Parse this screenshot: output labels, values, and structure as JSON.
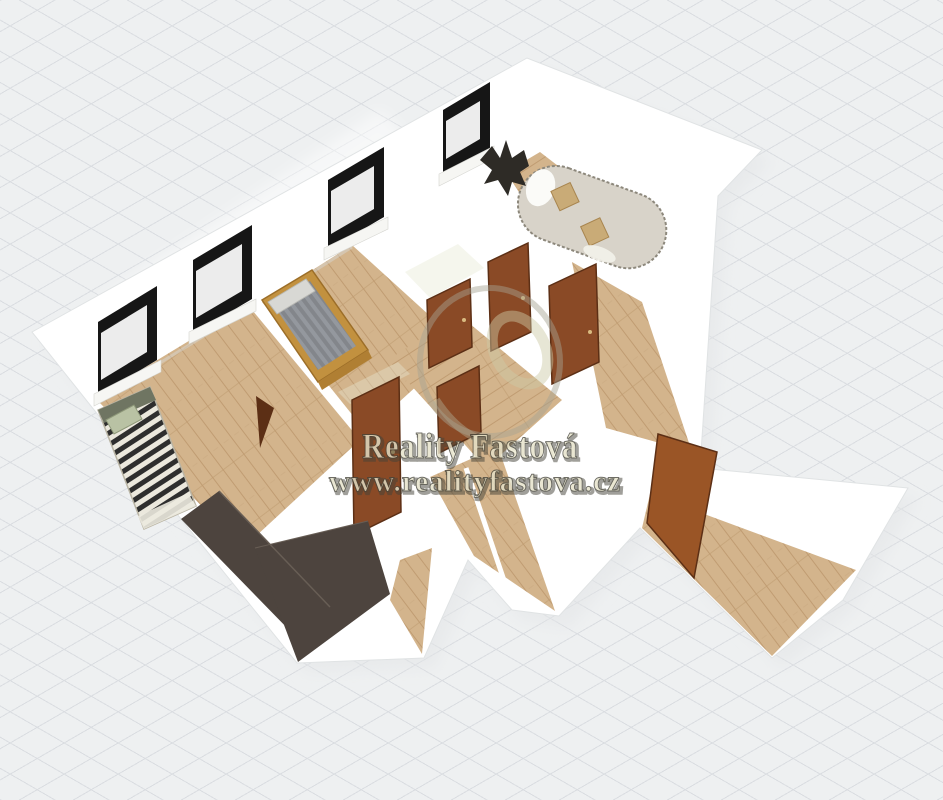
{
  "watermark": {
    "brand": "Reality Fastová",
    "url": "www.realityfastova.cz"
  },
  "scene": {
    "type": "3d-floor-plan-render",
    "background": {
      "base_color": "#eef0f1",
      "grid_line_color": "#dadde1",
      "grid_spacing_px": 27
    },
    "counts": {
      "windows": 4,
      "doors": 6,
      "rooms_visible": 5
    },
    "furniture": [
      "single-bed",
      "double-bed",
      "sofa",
      "plant",
      "kitchen-counter"
    ],
    "colors": {
      "wall": "#ffffff",
      "wall_shadow": "#e3e6e7",
      "cream_wall": "#eceede",
      "floor": "#d3b48c",
      "floor_dark": "#c09c72",
      "door": "#8a4a26",
      "door_dark": "#5c2f15",
      "door_open": "#9a5526",
      "window_frame": "#161616",
      "window_glass": "#ececec",
      "window_sill": "#f6f6f3",
      "counter": "#4d443e",
      "sofa": "#d8d3c9",
      "sofa_cushion": "#c9ab77",
      "bed_frame": "#c2913f",
      "bed_duvet": "#83868b",
      "bed_duvet_light": "#94989e",
      "stripe_dark": "#2e2e2e",
      "stripe_light": "#ebe8dd",
      "pillow_green": "#b9c2a4",
      "headboard": "#6f7562",
      "plant": "#2e2b26",
      "watermark_face": "#efecd2",
      "watermark_outline": "#45443a",
      "watermark_ring": "#a5a391"
    }
  }
}
